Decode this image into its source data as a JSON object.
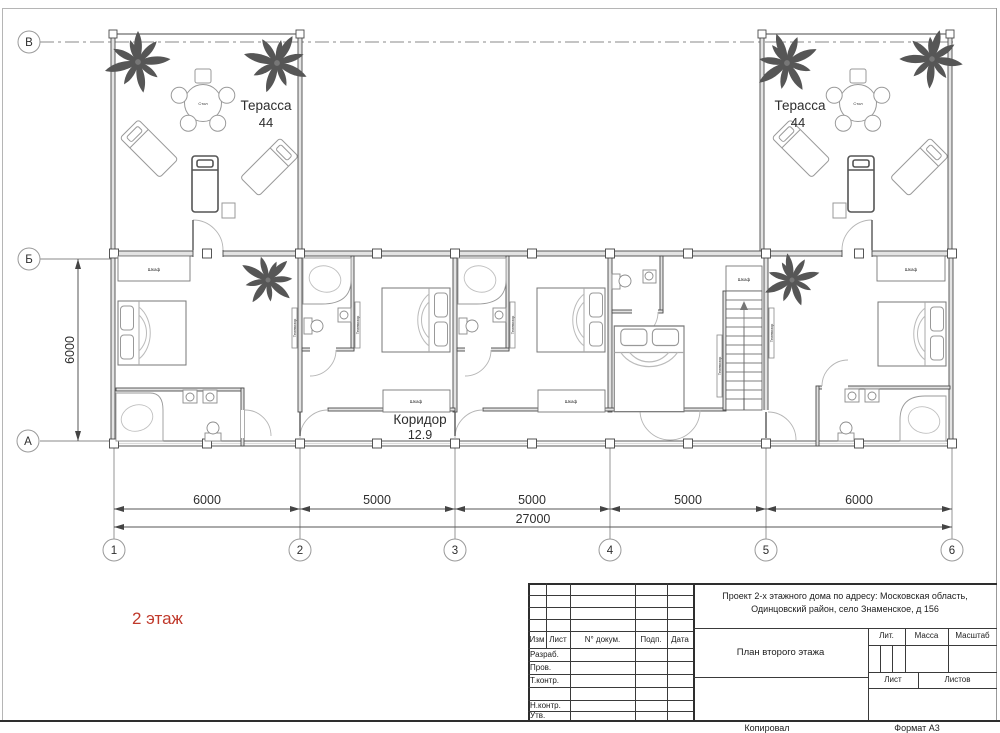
{
  "plan": {
    "floor_label": "2 этаж",
    "rooms": {
      "terrace_left": {
        "name": "Терасса",
        "area": "44"
      },
      "terrace_right": {
        "name": "Терасса",
        "area": "44"
      },
      "corridor": {
        "name": "Коридор",
        "area": "12.9"
      }
    },
    "furniture": {
      "table": "Стол",
      "wardrobe": "Шкаф",
      "tv": "Телевизор"
    },
    "axes": {
      "rows": [
        "В",
        "Б",
        "А"
      ],
      "cols": [
        "1",
        "2",
        "3",
        "4",
        "5",
        "6"
      ]
    },
    "dimensions": {
      "spans": [
        "6000",
        "5000",
        "5000",
        "5000",
        "6000"
      ],
      "total": "27000",
      "height": "6000"
    }
  },
  "title_block": {
    "project_line1": "Проект 2-х этажного дома по адресу: Московская область,",
    "project_line2": "Одинцовский район, село Знаменское, д 156",
    "drawing_title": "План второго этажа",
    "columns": {
      "izm": "Изм",
      "list": "Лист",
      "doc": "N° докум.",
      "podp": "Подп.",
      "data": "Дата"
    },
    "rows": {
      "razrab": "Разраб.",
      "prov": "Пров.",
      "tkontr": "Т.контр.",
      "nkontr": "Н.контр.",
      "utv": "Утв."
    },
    "stamp": {
      "lit": "Лит.",
      "massa": "Масса",
      "masshtab": "Масштаб",
      "list": "Лист",
      "listov": "Листов"
    }
  },
  "footer": {
    "copied": "Копировал",
    "format": "Формат А3"
  },
  "colors": {
    "accent_red": "#c0392b",
    "line": "#4a4a4a"
  }
}
